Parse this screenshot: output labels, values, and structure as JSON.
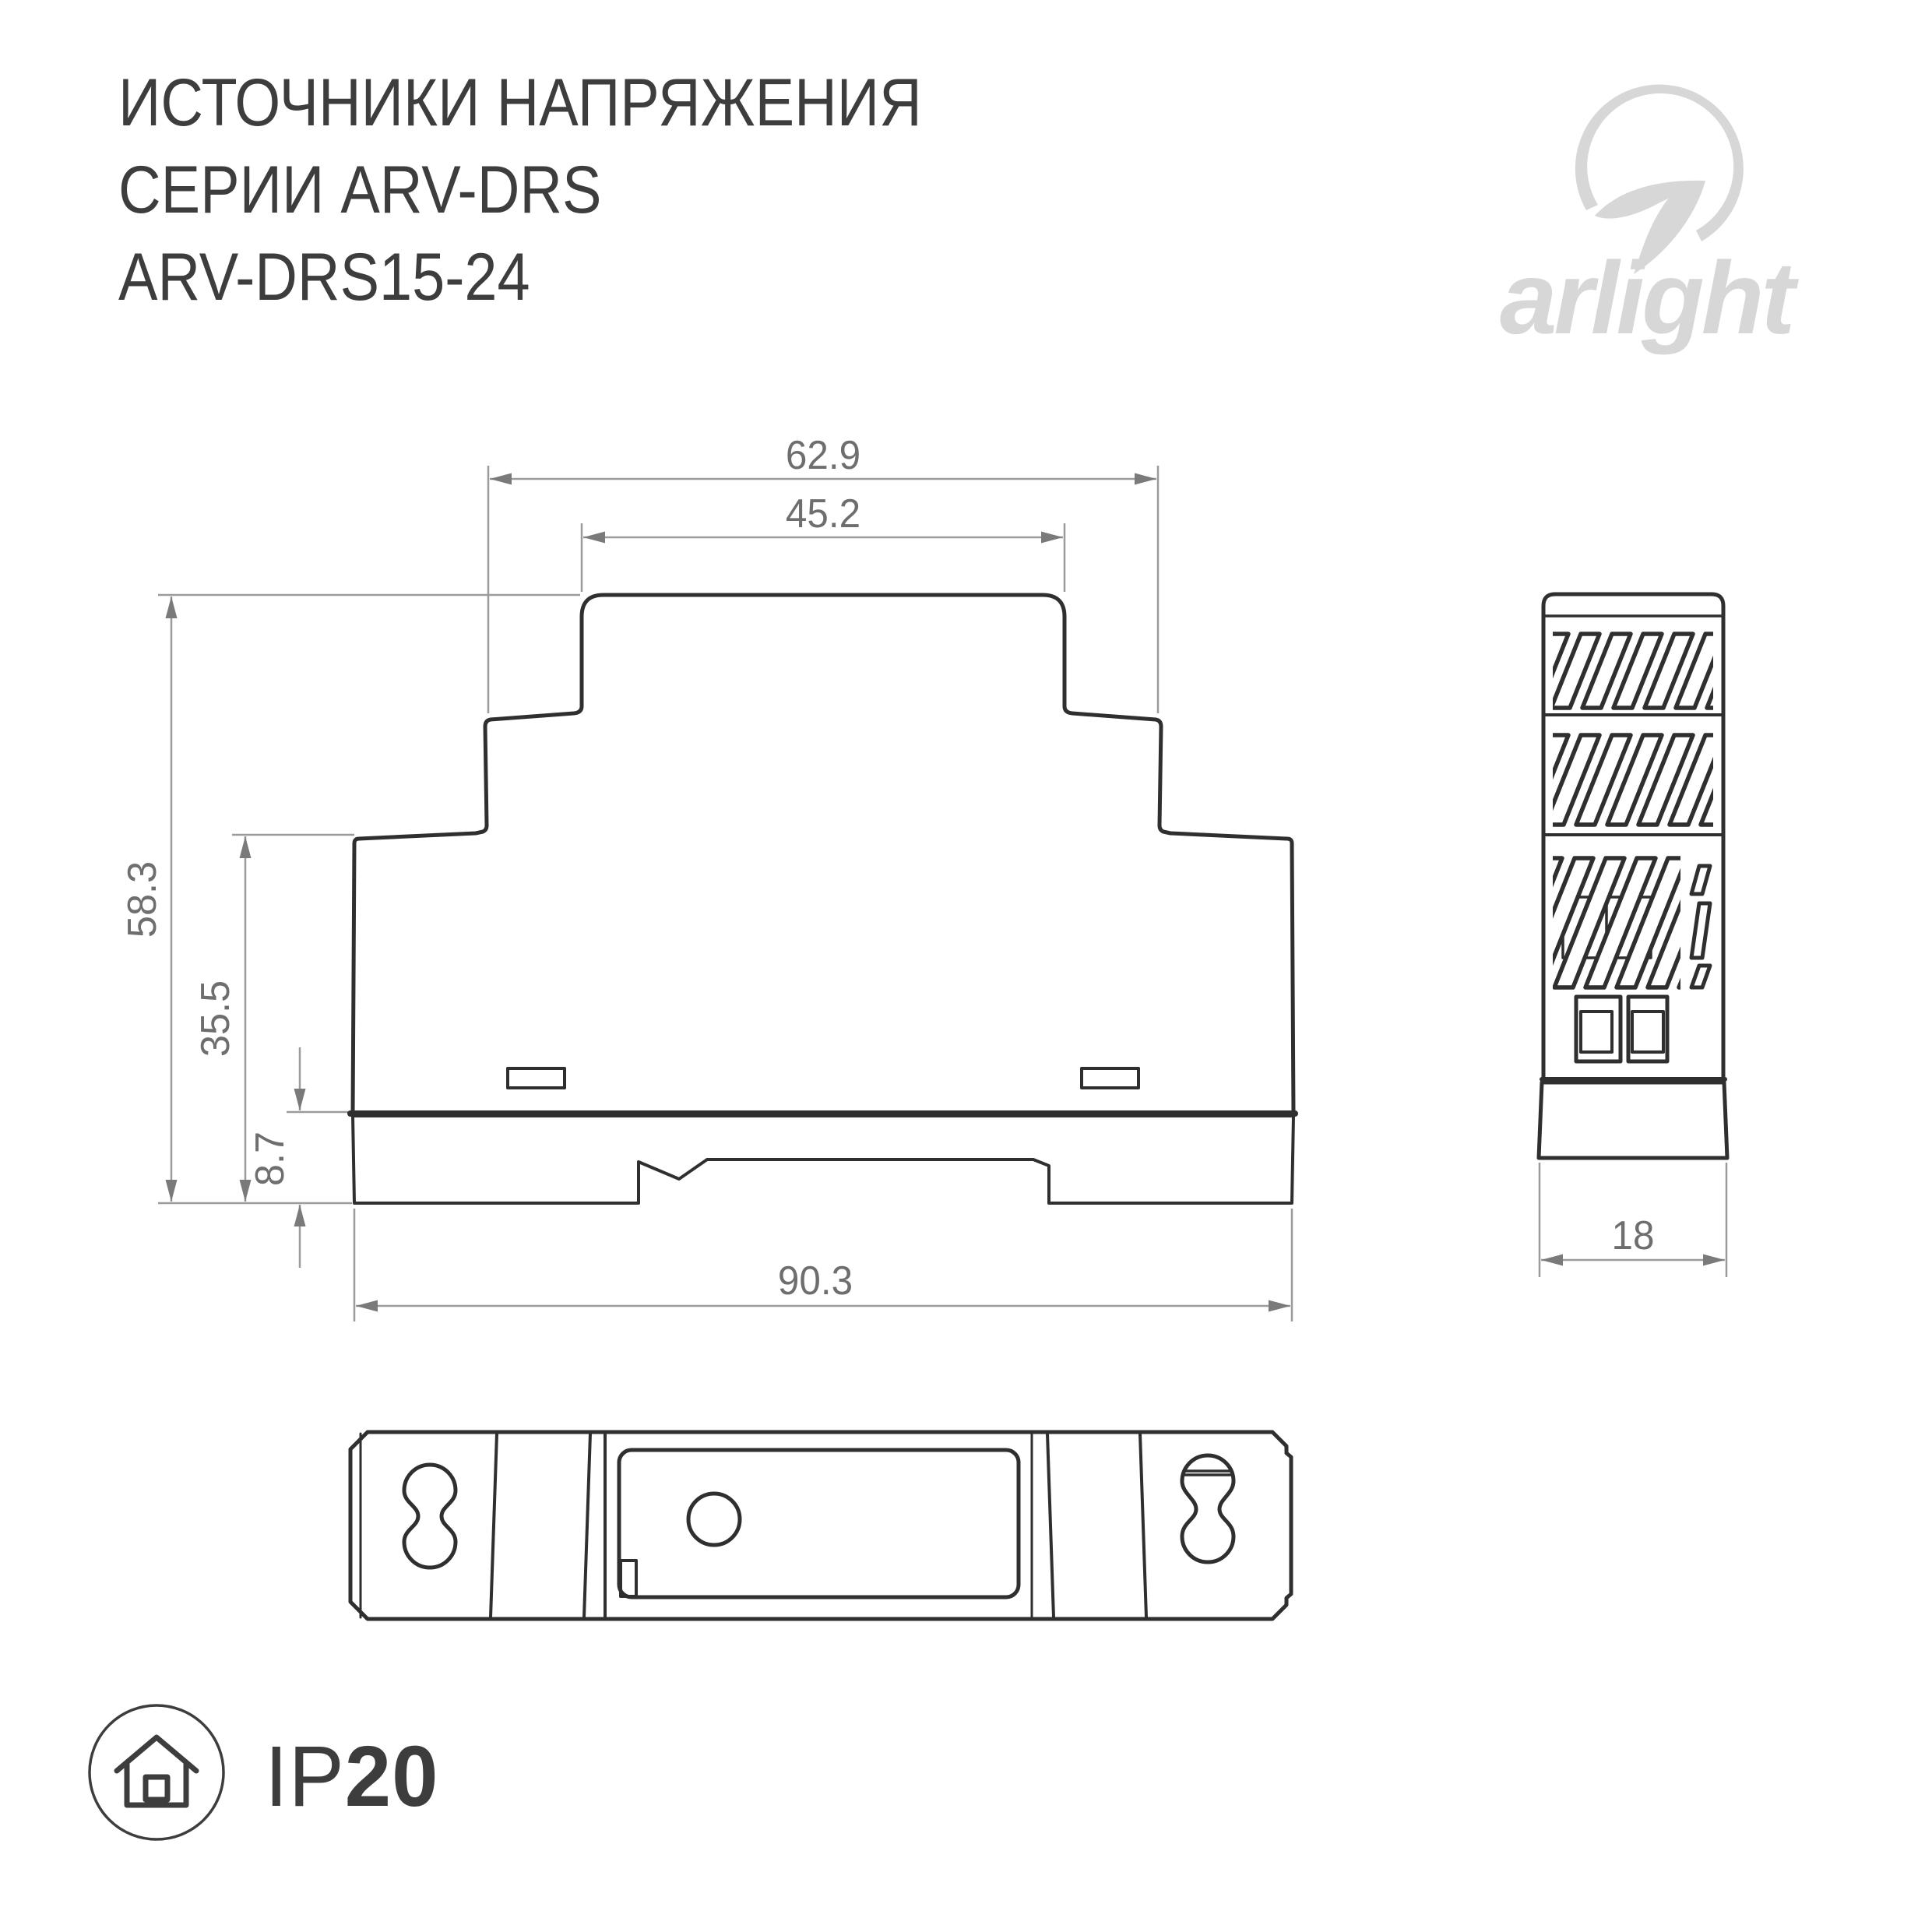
{
  "title": {
    "line1": "ИСТОЧНИКИ НАПРЯЖЕНИЯ",
    "line2": "СЕРИИ ARV-DRS",
    "line3": "ARV-DRS15-24"
  },
  "logo": {
    "text": "arlight"
  },
  "dimensions": {
    "front_step_width": "62.9",
    "front_cap_width": "45.2",
    "front_total_height": "58.3",
    "front_body_height": "35.5",
    "front_din_plate_height": "8.7",
    "front_total_width": "90.3",
    "side_width": "18"
  },
  "ip_rating": {
    "prefix": "IP",
    "value": "20"
  },
  "icons": {
    "logo_mark": "arlight-swoosh",
    "ip_icon": "house-in-circle"
  },
  "colors": {
    "line": "#2f2f2f",
    "dim_line": "#9b9b9b",
    "dim_arrow": "#7a7a7a",
    "dim_text": "#6e6e6e",
    "title_text": "#3d3d3d",
    "logo": "#d7d7d7"
  }
}
